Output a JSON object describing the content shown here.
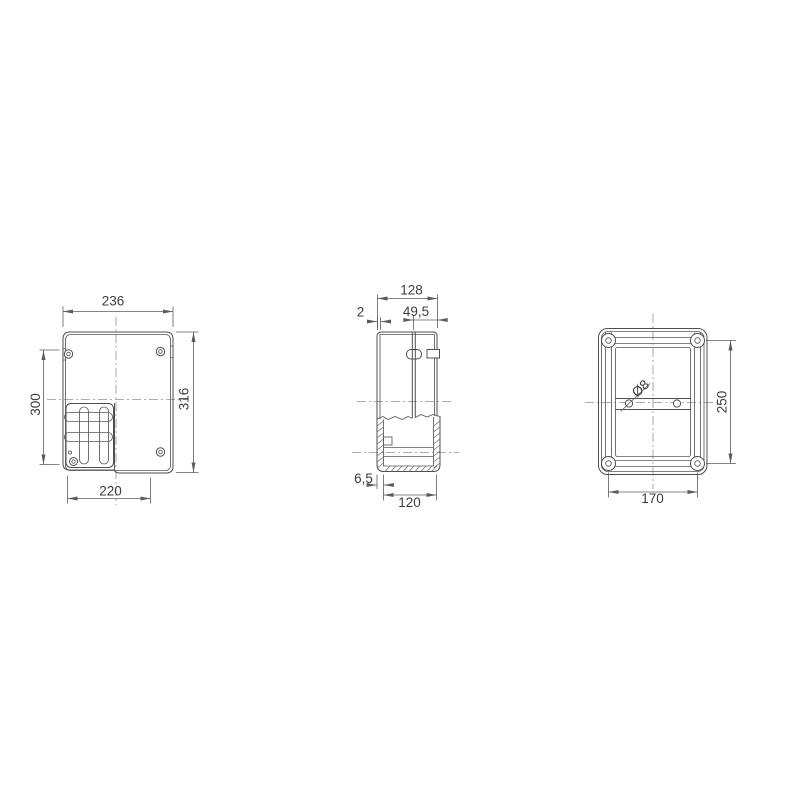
{
  "document": {
    "background": "#ffffff"
  },
  "colors": {
    "part_line": "#4f4f4f",
    "dimension_line": "#5c5c5c",
    "center_line": "#929292",
    "text": "#3d3d3d"
  },
  "views": {
    "front": {
      "dimensions": {
        "overall_width": "236",
        "overall_height": "316",
        "left_height": "300",
        "bottom_width": "220"
      }
    },
    "side": {
      "dimensions": {
        "overall_depth": "128",
        "lid_wall": "2",
        "lid_depth": "49,5",
        "base_wall": "6,5",
        "base_depth": "120"
      }
    },
    "back": {
      "dimensions": {
        "hole_diameter": "Ø8",
        "hole_pitch_vertical": "250",
        "hole_pitch_horizontal": "170"
      }
    }
  }
}
